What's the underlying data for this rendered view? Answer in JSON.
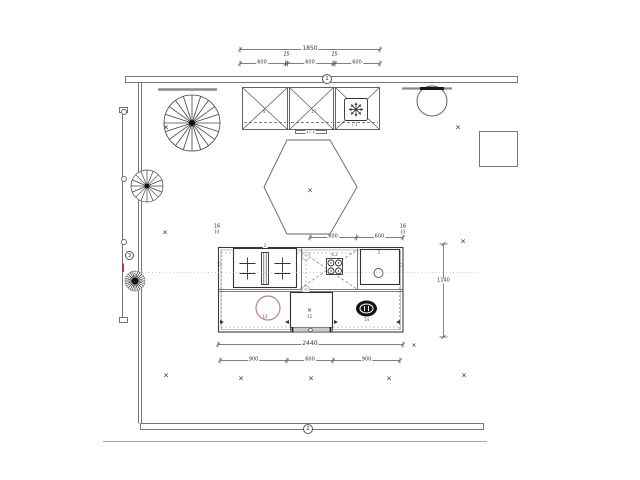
{
  "dims": {
    "top_total": "1850",
    "top_segments": [
      "600",
      "25",
      "600",
      "25",
      "600"
    ],
    "island_top": [
      "600",
      "600"
    ],
    "island_total": "2440",
    "island_bottom": [
      "900",
      "600",
      "900"
    ],
    "right_height": "1140",
    "overhangs": [
      "16",
      "16"
    ]
  },
  "section_markers": {
    "one": "1",
    "two": "2",
    "three": "3"
  },
  "item_labels": {
    "wall_cabinet_left": "4",
    "wall_cabinet_mid": "17",
    "extractor_hood": "7.1",
    "wall_shelf": "17.1",
    "island_unit": "2",
    "island_left_edge": "11",
    "hob": "6.2",
    "outlet_top": "4B",
    "outlet_bottom": "4A",
    "sink_inset": "2",
    "island_right_edge": "12",
    "cooktop_circle": "13",
    "dishwasher": "12",
    "basin_oval": "14"
  },
  "glyphs": {
    "cross_mark": "×"
  },
  "colors": {
    "linework": "#3c3c3c",
    "wall": "#777777",
    "beam": "#8a8a8a",
    "accent_red": "#cc2222",
    "circle_red": "#c67f7f",
    "dashed": "#8a8a8a",
    "reference_dotted": "#c9c9c9"
  }
}
